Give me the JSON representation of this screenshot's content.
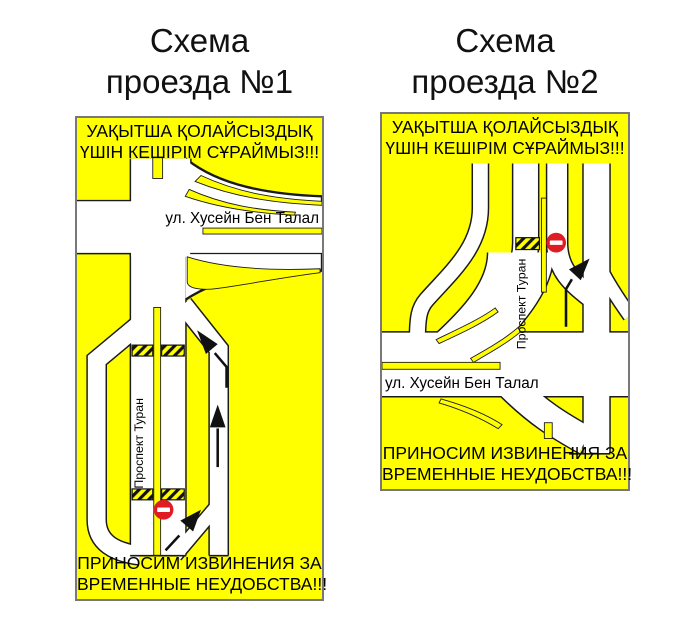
{
  "colors": {
    "panel_background": "#FFFF00",
    "road_surface": "#FFFFFF",
    "road_outline": "#1A1A1A",
    "no_entry_red": "#E01B24",
    "barrier_stripes": "#111111 / #FFFF00",
    "text_black": "#000000",
    "panel_border_gray": "#787878"
  },
  "schemes": [
    {
      "title": [
        "Схема",
        "проезда №1"
      ],
      "header": [
        "УАҚЫТША ҚОЛАЙСЫЗДЫҚ",
        "ҮШІН КЕШІРІМ СҰРАЙМЫЗ!!!"
      ],
      "street_label": "ул. Хусейн Бен Талал",
      "avenue_label": "Проспект Туран",
      "footer": [
        "ПРИНОСИМ ИЗВИНЕНИЯ ЗА",
        "ВРЕМЕННЫЕ НЕУДОБСТВА!!!"
      ],
      "icons": [
        "closure-barrier",
        "no-entry-sign",
        "detour-arrows"
      ]
    },
    {
      "title": [
        "Схема",
        "проезда №2"
      ],
      "header": [
        "УАҚЫТША ҚОЛАЙСЫЗДЫҚ",
        "ҮШІН КЕШІРІМ СҰРАЙМЫЗ!!!"
      ],
      "street_label": "ул. Хусейн Бен Талал",
      "avenue_label": "Проспект Туран",
      "footer": [
        "ПРИНОСИМ ИЗВИНЕНИЯ ЗА",
        "ВРЕМЕННЫЕ НЕУДОБСТВА!!!"
      ],
      "icons": [
        "closure-barrier",
        "no-entry-sign",
        "detour-arrow"
      ]
    }
  ]
}
